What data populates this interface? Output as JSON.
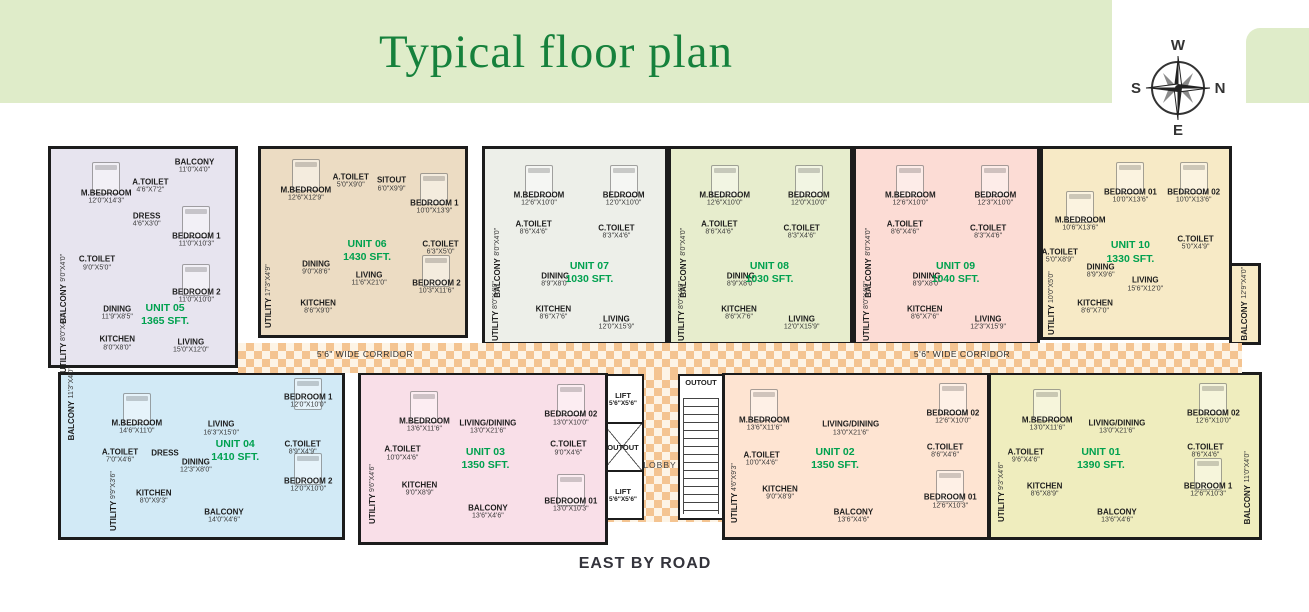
{
  "title": "Typical floor plan",
  "road_label": "EAST BY ROAD",
  "compass": {
    "top": "W",
    "right": "N",
    "bottom": "E",
    "left": "S"
  },
  "corridor": {
    "left_label": "5'6\" WIDE CORRIDOR",
    "right_label": "5'6\" WIDE CORRIDOR"
  },
  "core": {
    "lift_top_label": "LIFT",
    "lift_top_dim": "5'6\"X5'6\"",
    "duct_label": "OUTOUT",
    "lift_bottom_label": "LIFT",
    "lift_bottom_dim": "5'6\"X5'6\"",
    "stairs_duct_label": "OUTOUT",
    "lobby_label": "LOBBY"
  },
  "units": [
    {
      "id": "05",
      "label": "UNIT 05",
      "area": "1365 SFT.",
      "color": "#e7e4ef",
      "box": [
        48,
        146,
        190,
        222
      ],
      "lpos": [
        62,
        77
      ],
      "rooms": [
        {
          "label": "M.BEDROOM",
          "dim": "12'0\"X14'3\"",
          "x": 30,
          "y": 22,
          "bed": true
        },
        {
          "label": "A.TOILET",
          "dim": "4'6\"X7'2\"",
          "x": 54,
          "y": 17
        },
        {
          "label": "BALCONY",
          "dim": "11'0\"X4'0\"",
          "x": 78,
          "y": 8
        },
        {
          "label": "DRESS",
          "dim": "4'6\"X3'0\"",
          "x": 52,
          "y": 33
        },
        {
          "label": "BEDROOM 1",
          "dim": "11'0\"X10'3\"",
          "x": 79,
          "y": 42,
          "bed": true
        },
        {
          "label": "C.TOILET",
          "dim": "9'0\"X5'0\"",
          "x": 25,
          "y": 53
        },
        {
          "label": "BEDROOM 2",
          "dim": "11'0\"X10'0\"",
          "x": 79,
          "y": 68,
          "bed": true
        },
        {
          "label": "BALCONY",
          "dim": "9'0\"X4'0\"",
          "x": 7,
          "y": 65,
          "v": true
        },
        {
          "label": "DINING",
          "dim": "11'9\"X8'5\"",
          "x": 36,
          "y": 76
        },
        {
          "label": "UTILITY",
          "dim": "8'0\"X4'0\"",
          "x": 7,
          "y": 90,
          "v": true
        },
        {
          "label": "KITCHEN",
          "dim": "8'0\"X8'0\"",
          "x": 36,
          "y": 90
        },
        {
          "label": "LIVING",
          "dim": "15'0\"X12'0\"",
          "x": 76,
          "y": 91
        }
      ]
    },
    {
      "id": "06",
      "label": "UNIT 06",
      "area": "1430 SFT.",
      "color": "#ecdcc3",
      "box": [
        258,
        146,
        210,
        192
      ],
      "lpos": [
        52,
        55
      ],
      "rooms": [
        {
          "label": "M.BEDROOM",
          "dim": "12'6\"X12'9\"",
          "x": 22,
          "y": 24,
          "bed": true
        },
        {
          "label": "A.TOILET",
          "dim": "5'0\"X9'0\"",
          "x": 44,
          "y": 17
        },
        {
          "label": "SITOUT",
          "dim": "6'0\"X9'9\"",
          "x": 64,
          "y": 19
        },
        {
          "label": "BEDROOM 1",
          "dim": "10'0\"X13'9\"",
          "x": 85,
          "y": 31,
          "bed": true
        },
        {
          "label": "C.TOILET",
          "dim": "6'3\"X5'0\"",
          "x": 88,
          "y": 53
        },
        {
          "label": "DINING",
          "dim": "9'0\"X8'6\"",
          "x": 27,
          "y": 64
        },
        {
          "label": "LIVING",
          "dim": "11'6\"X21'0\"",
          "x": 53,
          "y": 70
        },
        {
          "label": "UTILITY",
          "dim": "17'3\"X4'9\"",
          "x": 4,
          "y": 79,
          "v": true
        },
        {
          "label": "KITCHEN",
          "dim": "8'6\"X9'0\"",
          "x": 28,
          "y": 85
        },
        {
          "label": "BEDROOM 2",
          "dim": "10'3\"X11'6\"",
          "x": 86,
          "y": 74,
          "bed": true
        }
      ]
    },
    {
      "id": "07",
      "label": "UNIT 07",
      "area": "1030 SFT.",
      "color": "#edefe9",
      "box": [
        482,
        146,
        186,
        199
      ],
      "lpos": [
        58,
        64
      ],
      "rooms": [
        {
          "label": "M.BEDROOM",
          "dim": "12'6\"X10'0\"",
          "x": 30,
          "y": 26,
          "bed": true
        },
        {
          "label": "BEDROOM",
          "dim": "12'0\"X10'0\"",
          "x": 77,
          "y": 26,
          "bed": true
        },
        {
          "label": "A.TOILET",
          "dim": "8'6\"X4'6\"",
          "x": 27,
          "y": 41
        },
        {
          "label": "C.TOILET",
          "dim": "8'3\"X4'6\"",
          "x": 73,
          "y": 43
        },
        {
          "label": "BALCONY",
          "dim": "8'0\"X4'0\"",
          "x": 7,
          "y": 59,
          "v": true
        },
        {
          "label": "DINING",
          "dim": "8'9\"X8'0\"",
          "x": 39,
          "y": 68
        },
        {
          "label": "UTILITY",
          "dim": "8'0\"X4'0\"",
          "x": 6,
          "y": 84,
          "v": true
        },
        {
          "label": "KITCHEN",
          "dim": "8'6\"X7'6\"",
          "x": 38,
          "y": 85
        },
        {
          "label": "LIVING",
          "dim": "12'0\"X15'9\"",
          "x": 73,
          "y": 90
        }
      ]
    },
    {
      "id": "08",
      "label": "UNIT 08",
      "area": "1030 SFT.",
      "color": "#e7edcd",
      "box": [
        668,
        146,
        185,
        199
      ],
      "lpos": [
        55,
        64
      ],
      "rooms": [
        {
          "label": "M.BEDROOM",
          "dim": "12'6\"X10'0\"",
          "x": 30,
          "y": 26,
          "bed": true
        },
        {
          "label": "BEDROOM",
          "dim": "12'0\"X10'0\"",
          "x": 77,
          "y": 26,
          "bed": true
        },
        {
          "label": "A.TOILET",
          "dim": "8'6\"X4'6\"",
          "x": 27,
          "y": 41
        },
        {
          "label": "C.TOILET",
          "dim": "8'3\"X4'6\"",
          "x": 73,
          "y": 43
        },
        {
          "label": "BALCONY",
          "dim": "8'0\"X4'0\"",
          "x": 7,
          "y": 59,
          "v": true
        },
        {
          "label": "DINING",
          "dim": "8'9\"X8'0\"",
          "x": 39,
          "y": 68
        },
        {
          "label": "UTILITY",
          "dim": "8'0\"X4'0\"",
          "x": 6,
          "y": 84,
          "v": true
        },
        {
          "label": "KITCHEN",
          "dim": "8'6\"X7'6\"",
          "x": 38,
          "y": 85
        },
        {
          "label": "LIVING",
          "dim": "12'0\"X15'9\"",
          "x": 73,
          "y": 90
        }
      ]
    },
    {
      "id": "09",
      "label": "UNIT 09",
      "area": "1040 SFT.",
      "color": "#fcdcd5",
      "box": [
        853,
        146,
        187,
        199
      ],
      "lpos": [
        55,
        64
      ],
      "rooms": [
        {
          "label": "M.BEDROOM",
          "dim": "12'6\"X10'0\"",
          "x": 30,
          "y": 26,
          "bed": true
        },
        {
          "label": "BEDROOM",
          "dim": "12'3\"X10'0\"",
          "x": 77,
          "y": 26,
          "bed": true
        },
        {
          "label": "A.TOILET",
          "dim": "8'6\"X4'6\"",
          "x": 27,
          "y": 41
        },
        {
          "label": "C.TOILET",
          "dim": "8'3\"X4'6\"",
          "x": 73,
          "y": 43
        },
        {
          "label": "BALCONY",
          "dim": "8'0\"X4'0\"",
          "x": 7,
          "y": 59,
          "v": true
        },
        {
          "label": "DINING",
          "dim": "8'9\"X8'0\"",
          "x": 39,
          "y": 68
        },
        {
          "label": "UTILITY",
          "dim": "8'0\"X4'0\"",
          "x": 6,
          "y": 84,
          "v": true
        },
        {
          "label": "KITCHEN",
          "dim": "8'6\"X7'6\"",
          "x": 38,
          "y": 85
        },
        {
          "label": "LIVING",
          "dim": "12'3\"X15'9\"",
          "x": 73,
          "y": 90
        }
      ]
    },
    {
      "id": "10",
      "label": "UNIT 10",
      "area": "1330 SFT.",
      "color": "#f7eac6",
      "box": [
        1040,
        146,
        192,
        194
      ],
      "lpos": [
        47,
        55
      ],
      "annex": {
        "box": [
          1229,
          263,
          32,
          82
        ],
        "label": "BALCONY",
        "dim": "12'9\"X4'0\""
      },
      "rooms": [
        {
          "label": "M.BEDROOM",
          "dim": "10'6\"X13'6\"",
          "x": 20,
          "y": 40,
          "bed": true
        },
        {
          "label": "BEDROOM 01",
          "dim": "10'0\"X13'6\"",
          "x": 47,
          "y": 25,
          "bed": true
        },
        {
          "label": "BEDROOM 02",
          "dim": "10'0\"X13'6\"",
          "x": 81,
          "y": 25,
          "bed": true
        },
        {
          "label": "A.TOILET",
          "dim": "5'0\"X8'9\"",
          "x": 9,
          "y": 57
        },
        {
          "label": "C.TOILET",
          "dim": "5'0\"X4'9\"",
          "x": 82,
          "y": 50
        },
        {
          "label": "DINING",
          "dim": "8'9\"X9'6\"",
          "x": 31,
          "y": 65
        },
        {
          "label": "LIVING",
          "dim": "15'6\"X12'0\"",
          "x": 55,
          "y": 72
        },
        {
          "label": "UTILITY",
          "dim": "10'0\"X5'0\"",
          "x": 5,
          "y": 82,
          "v": true
        },
        {
          "label": "KITCHEN",
          "dim": "8'6\"X7'0\"",
          "x": 28,
          "y": 84
        }
      ]
    },
    {
      "id": "04",
      "label": "UNIT 04",
      "area": "1410 SFT.",
      "color": "#d2eaf6",
      "box": [
        58,
        372,
        287,
        168
      ],
      "lpos": [
        62,
        47
      ],
      "rooms": [
        {
          "label": "BALCONY",
          "dim": "11'3\"X4'0\"",
          "x": 4,
          "y": 18,
          "v": true
        },
        {
          "label": "M.BEDROOM",
          "dim": "14'6\"X11'0\"",
          "x": 27,
          "y": 32,
          "bed": true
        },
        {
          "label": "LIVING",
          "dim": "16'3\"X15'0\"",
          "x": 57,
          "y": 33
        },
        {
          "label": "A.TOILET",
          "dim": "7'0\"X4'6\"",
          "x": 21,
          "y": 50
        },
        {
          "label": "DRESS",
          "dim": "",
          "x": 37,
          "y": 48
        },
        {
          "label": "DINING",
          "dim": "12'3\"X8'0\"",
          "x": 48,
          "y": 56
        },
        {
          "label": "UTILITY",
          "dim": "9'9\"X3'6\"",
          "x": 19,
          "y": 78,
          "v": true
        },
        {
          "label": "KITCHEN",
          "dim": "8'0\"X9'3\"",
          "x": 33,
          "y": 75
        },
        {
          "label": "BALCONY",
          "dim": "14'0\"X4'6\"",
          "x": 58,
          "y": 87
        },
        {
          "label": "BEDROOM 1",
          "dim": "12'0\"X10'0\"",
          "x": 88,
          "y": 16,
          "bed": true
        },
        {
          "label": "C.TOILET",
          "dim": "8'9\"X4'9\"",
          "x": 86,
          "y": 45
        },
        {
          "label": "BEDROOM 2",
          "dim": "12'0\"X10'0\"",
          "x": 88,
          "y": 68,
          "bed": true
        }
      ]
    },
    {
      "id": "03",
      "label": "UNIT 03",
      "area": "1350 SFT.",
      "color": "#f9dfe8",
      "box": [
        358,
        372,
        250,
        173
      ],
      "lpos": [
        51,
        50
      ],
      "rooms": [
        {
          "label": "M.BEDROOM",
          "dim": "13'6\"X11'6\"",
          "x": 26,
          "y": 30,
          "bed": true
        },
        {
          "label": "LIVING/DINING",
          "dim": "13'0\"X21'6\"",
          "x": 52,
          "y": 31
        },
        {
          "label": "BEDROOM 02",
          "dim": "13'0\"X10'0\"",
          "x": 86,
          "y": 26,
          "bed": true
        },
        {
          "label": "A.TOILET",
          "dim": "10'0\"X4'6\"",
          "x": 17,
          "y": 47
        },
        {
          "label": "C.TOILET",
          "dim": "9'0\"X4'6\"",
          "x": 85,
          "y": 44
        },
        {
          "label": "UTILITY",
          "dim": "9'6\"X4'6\"",
          "x": 5,
          "y": 71,
          "v": true
        },
        {
          "label": "KITCHEN",
          "dim": "9'0\"X8'9\"",
          "x": 24,
          "y": 68
        },
        {
          "label": "BALCONY",
          "dim": "13'6\"X4'6\"",
          "x": 52,
          "y": 82
        },
        {
          "label": "BEDROOM 01",
          "dim": "13'0\"X10'3\"",
          "x": 86,
          "y": 78,
          "bed": true
        }
      ]
    },
    {
      "id": "02",
      "label": "UNIT 02",
      "area": "1350 SFT.",
      "color": "#fee4d2",
      "box": [
        722,
        372,
        268,
        168
      ],
      "lpos": [
        42,
        52
      ],
      "rooms": [
        {
          "label": "M.BEDROOM",
          "dim": "13'6\"X11'6\"",
          "x": 15,
          "y": 30,
          "bed": true
        },
        {
          "label": "LIVING/DINING",
          "dim": "13'0\"X21'6\"",
          "x": 48,
          "y": 33
        },
        {
          "label": "BEDROOM 02",
          "dim": "12'6\"X10'0\"",
          "x": 87,
          "y": 26,
          "bed": true
        },
        {
          "label": "A.TOILET",
          "dim": "10'0\"X4'6\"",
          "x": 14,
          "y": 52
        },
        {
          "label": "C.TOILET",
          "dim": "8'6\"X4'6\"",
          "x": 84,
          "y": 47
        },
        {
          "label": "UTILITY",
          "dim": "4'6\"X9'3\"",
          "x": 4,
          "y": 73,
          "v": true
        },
        {
          "label": "KITCHEN",
          "dim": "9'0\"X8'9\"",
          "x": 21,
          "y": 73
        },
        {
          "label": "BALCONY",
          "dim": "13'6\"X4'6\"",
          "x": 49,
          "y": 87
        },
        {
          "label": "BEDROOM 01",
          "dim": "12'6\"X10'3\"",
          "x": 86,
          "y": 78,
          "bed": true
        }
      ]
    },
    {
      "id": "01",
      "label": "UNIT 01",
      "area": "1390 SFT.",
      "color": "#efedbe",
      "box": [
        988,
        372,
        274,
        168
      ],
      "lpos": [
        41,
        52
      ],
      "rooms": [
        {
          "label": "M.BEDROOM",
          "dim": "13'0\"X11'6\"",
          "x": 21,
          "y": 30,
          "bed": true
        },
        {
          "label": "LIVING/DINING",
          "dim": "13'0\"X21'6\"",
          "x": 47,
          "y": 32
        },
        {
          "label": "BEDROOM 02",
          "dim": "12'6\"X10'0\"",
          "x": 83,
          "y": 26,
          "bed": true
        },
        {
          "label": "A.TOILET",
          "dim": "9'6\"X4'6\"",
          "x": 13,
          "y": 50
        },
        {
          "label": "C.TOILET",
          "dim": "8'6\"X4'6\"",
          "x": 80,
          "y": 47
        },
        {
          "label": "UTILITY",
          "dim": "9'3\"X4'6\"",
          "x": 4,
          "y": 72,
          "v": true
        },
        {
          "label": "KITCHEN",
          "dim": "8'6\"X8'9\"",
          "x": 20,
          "y": 71
        },
        {
          "label": "BALCONY",
          "dim": "13'6\"X4'6\"",
          "x": 47,
          "y": 87
        },
        {
          "label": "BEDROOM 1",
          "dim": "12'6\"X10'3\"",
          "x": 81,
          "y": 71,
          "bed": true
        },
        {
          "label": "BALCONY",
          "dim": "11'0\"X4'0\"",
          "x": 96,
          "y": 70,
          "v": true
        }
      ]
    }
  ]
}
